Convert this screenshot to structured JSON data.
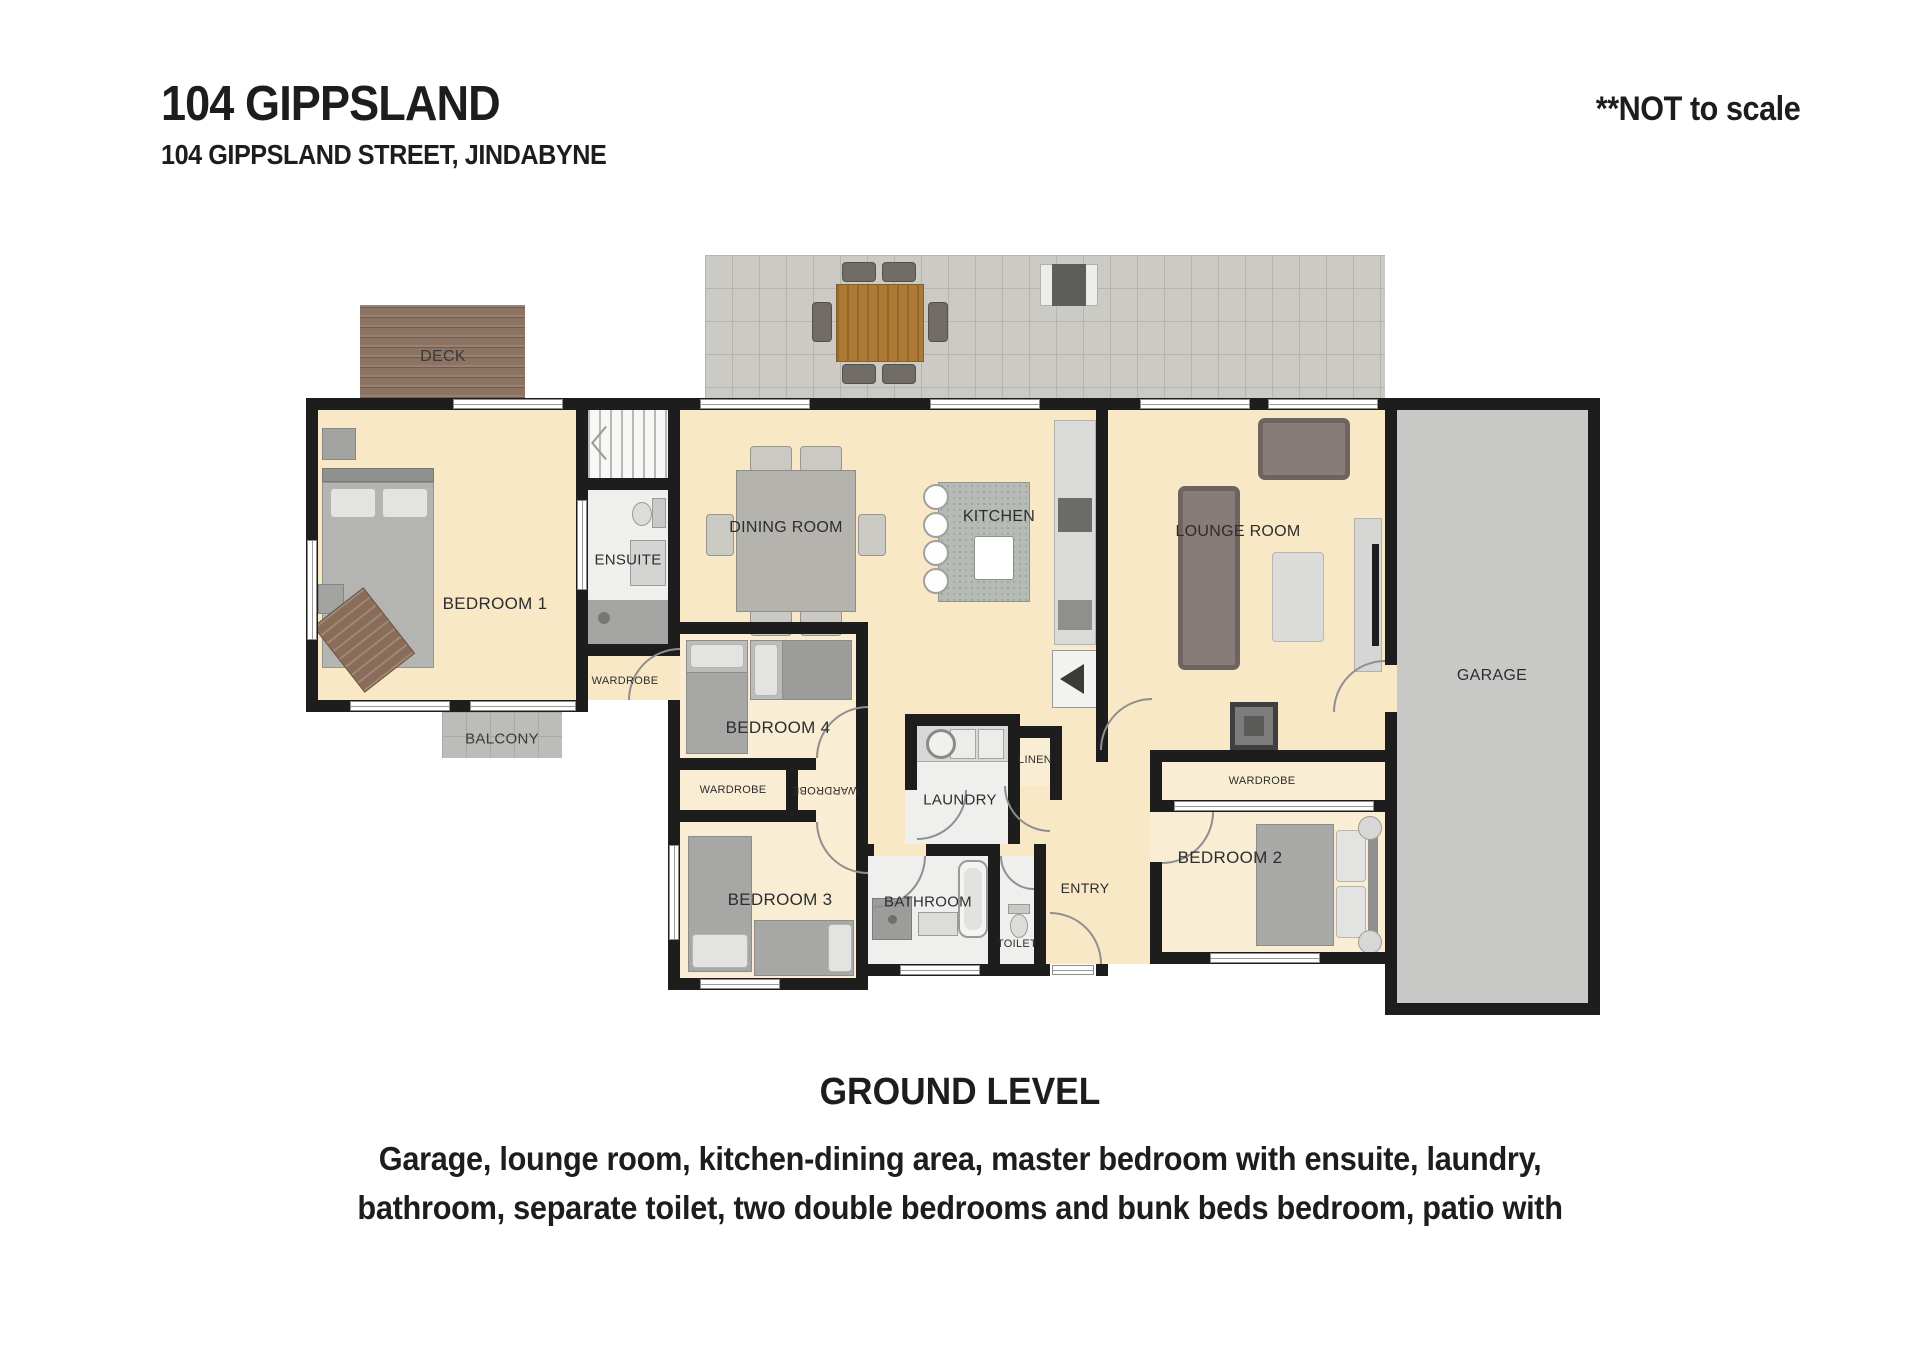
{
  "header": {
    "title": "104 GIPPSLAND",
    "subtitle": "104 GIPPSLAND STREET, JINDABYNE",
    "scale_note": "**NOT to scale"
  },
  "plan": {
    "outdoor": {
      "deck": "DECK",
      "balcony": "BALCONY"
    },
    "rooms": {
      "bedroom1": "BEDROOM 1",
      "ensuite": "ENSUITE",
      "wardrobe_bedroom1": "WARDROBE",
      "dining": "DINING ROOM",
      "kitchen": "KITCHEN",
      "lounge": "LOUNGE ROOM",
      "garage": "GARAGE",
      "bedroom4": "BEDROOM 4",
      "wardrobe_left": "WARDROBE",
      "wardrobe_right": "WARDROBE",
      "bedroom3": "BEDROOM 3",
      "laundry": "LAUNDRY",
      "linen": "LINEN",
      "bathroom": "BATHROOM",
      "toilet": "TOILET",
      "entry": "ENTRY",
      "bedroom2": "BEDROOM 2",
      "wardrobe_bedroom2": "WARDROBE"
    }
  },
  "footer": {
    "level": "GROUND LEVEL",
    "description": [
      "Garage, lounge room, kitchen-dining area, master bedroom with ensuite, laundry,",
      "bathroom, separate toilet, two double bedrooms and bunk beds bedroom, patio with"
    ]
  },
  "colors": {
    "wall": "#1d1d1d",
    "floor_main": "#f8e8c5",
    "floor_bedroom": "#f9edd3",
    "floor_wet": "#efefed",
    "patio": "#cbcac5",
    "deck": "#8c7362",
    "garage": "#c8c8c6",
    "balcony": "#bcbcb9",
    "text": "#1d1d1d"
  }
}
